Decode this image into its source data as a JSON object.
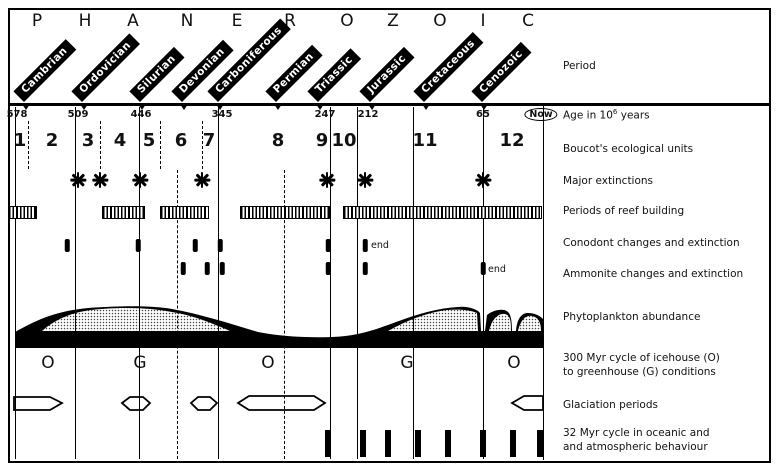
{
  "eon": {
    "letters": [
      "P",
      "H",
      "A",
      "N",
      "E",
      "R",
      "O",
      "Z",
      "O",
      "I",
      "C"
    ],
    "letter_xs": [
      37,
      85,
      133,
      187,
      237,
      290,
      347,
      393,
      440,
      483,
      528
    ]
  },
  "periods": [
    {
      "name": "Cambrian",
      "x": 24
    },
    {
      "name": "Ordovician",
      "x": 82
    },
    {
      "name": "Silurian",
      "x": 140
    },
    {
      "name": "Devonian",
      "x": 182
    },
    {
      "name": "Carboniferous",
      "x": 218
    },
    {
      "name": "Permian",
      "x": 276
    },
    {
      "name": "Triassic",
      "x": 318
    },
    {
      "name": "Jurassic",
      "x": 370
    },
    {
      "name": "Cretaceous",
      "x": 424
    },
    {
      "name": "Cenozoic",
      "x": 482
    }
  ],
  "ages": [
    {
      "label": "578",
      "x": 17
    },
    {
      "label": "509",
      "x": 78
    },
    {
      "label": "446",
      "x": 141
    },
    {
      "label": "345",
      "x": 222
    },
    {
      "label": "247",
      "x": 325
    },
    {
      "label": "212",
      "x": 368
    },
    {
      "label": "65",
      "x": 483
    }
  ],
  "now_label": "Now",
  "units": [
    {
      "label": "1",
      "x": 20
    },
    {
      "label": "2",
      "x": 52
    },
    {
      "label": "3",
      "x": 88
    },
    {
      "label": "4",
      "x": 120
    },
    {
      "label": "5",
      "x": 149
    },
    {
      "label": "6",
      "x": 181
    },
    {
      "label": "7",
      "x": 209
    },
    {
      "label": "8",
      "x": 278
    },
    {
      "label": "9",
      "x": 322
    },
    {
      "label": "10",
      "x": 344
    },
    {
      "label": "11",
      "x": 425
    },
    {
      "label": "12",
      "x": 512
    }
  ],
  "extinctions_x": [
    78,
    100,
    140,
    202,
    327,
    365,
    483
  ],
  "reef_bars": [
    [
      8,
      35
    ],
    [
      102,
      143
    ],
    [
      160,
      207
    ],
    [
      240,
      328
    ],
    [
      343,
      540
    ]
  ],
  "conodont": {
    "marks_x": [
      67,
      138,
      195,
      220,
      328,
      365
    ],
    "end_label": "end",
    "end_x": 371,
    "end_y": 240
  },
  "ammonite": {
    "marks_x": [
      183,
      207,
      222,
      328,
      365,
      483
    ],
    "end_label": "end",
    "end_x": 488,
    "end_y": 264
  },
  "climate_letters": [
    {
      "label": "O",
      "x": 48
    },
    {
      "label": "G",
      "x": 140
    },
    {
      "label": "O",
      "x": 268
    },
    {
      "label": "G",
      "x": 407
    },
    {
      "label": "O",
      "x": 514
    }
  ],
  "cycle_bars_x": [
    328,
    363,
    388,
    418,
    448,
    483,
    513,
    540
  ],
  "gridlines": {
    "solid_x": [
      15,
      75,
      139,
      218,
      330,
      357,
      413,
      483
    ],
    "dashed_partial_x": [
      177,
      284
    ],
    "units_dashed_x": [
      28,
      100,
      160,
      202
    ]
  },
  "phytoplankton": {
    "area_path": "M15,332 C40,318 58,311 88,308 C115,306 150,305 172,309 C200,314 228,323 258,332 C278,336 305,338 332,337 C356,336 372,331 396,322 C418,314 438,308 458,307 C466,306 473,308 478,311 L480,313 L481,331 L485,331 L487,315 C492,311 499,309 504,310 C509,311 512,315 512,331 L516,331 C517,318 522,313 528,313 C535,313 540,316 543,319 L543,348 L15,348 Z",
    "stipple_paths": [
      "M42,331 C60,315 82,310 102,309 C127,307 152,308 172,312 C192,315 212,323 230,331 Z",
      "M388,331 C404,322 424,313 447,310 C461,309 470,310 477,313 L478,331 Z",
      "M489,331 C492,317 500,313 505,314 C510,315 511,320 511,331 Z",
      "M518,331 C521,318 527,315 532,316 C538,317 541,322 541,331 Z"
    ]
  },
  "glaciation_shapes": [
    "14,397 50,397 62,403 50,410 14,410",
    "122,403 130,397 143,397 150,403 143,410 130,410",
    "191,403 198,397 210,397 217,403 210,410 198,410",
    "238,403 249,396 314,396 325,403 314,410 249,410",
    "543,396 524,396 512,403 524,410 543,410"
  ],
  "row_labels": {
    "period": "Period",
    "age_prefix": "Age in 10",
    "age_sup": "6",
    "age_suffix": " years",
    "units": "Boucot's ecological units",
    "extinctions": "Major extinctions",
    "reef": "Periods of reef building",
    "conodont": "Conodont changes and extinction",
    "ammonite": "Ammonite changes and extinction",
    "phytoplankton": "Phytoplankton abundance",
    "icehouse_line1": "300 Myr cycle of icehouse (O)",
    "icehouse_line2": "to greenhouse (G) conditions",
    "glaciation": "Glaciation periods",
    "cycle_line1": "32 Myr cycle in oceanic and",
    "cycle_line2": "and atmospheric behaviour"
  },
  "colors": {
    "ink": "#111111",
    "paper": "#ffffff"
  }
}
